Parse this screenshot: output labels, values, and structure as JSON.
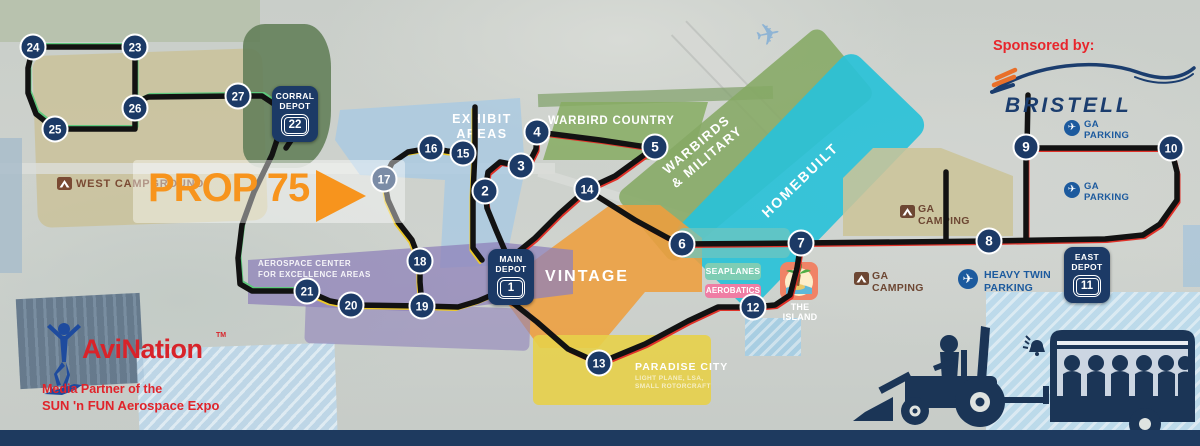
{
  "prop_overlay": {
    "label": "PROP 75"
  },
  "sponsor": {
    "label": "Sponsored by:",
    "brand": "BRISTELL"
  },
  "media_partner": {
    "brand": "AviNation",
    "tm": "TM",
    "line1": "Media Partner of the",
    "line2": "SUN 'n FUN Aerospace Expo"
  },
  "depots": {
    "corral": {
      "line1": "CORRAL",
      "line2": "DEPOT",
      "number": "22"
    },
    "main": {
      "line1": "MAIN",
      "line2": "DEPOT",
      "number": "1"
    },
    "east": {
      "line1": "EAST",
      "line2": "DEPOT",
      "number": "11"
    }
  },
  "areas": {
    "west_campground": {
      "label": "WEST CAMPGROUND"
    },
    "exhibit": {
      "line1": "EXHIBIT",
      "line2": "AREAS"
    },
    "warbird_country": {
      "label": "WARBIRD COUNTRY"
    },
    "warbirds_military": {
      "line1": "WARBIRDS",
      "line2": "& MILITARY"
    },
    "homebuilt": {
      "label": "HOMEBUILT"
    },
    "vintage": {
      "label": "VINTAGE"
    },
    "ga_camping_north": {
      "line1": "GA",
      "line2": "CAMPING"
    },
    "ga_camping_south": {
      "line1": "GA",
      "line2": "CAMPING"
    },
    "ga_parking_north": {
      "line1": "GA",
      "line2": "PARKING"
    },
    "ga_parking_south": {
      "line1": "GA",
      "line2": "PARKING"
    },
    "seaplanes": {
      "label": "SEAPLANES"
    },
    "aerobatics": {
      "label": "AEROBATICS"
    },
    "island": {
      "label": "THE ISLAND"
    },
    "heavy_twin": {
      "line1": "HEAVY TWIN",
      "line2": "PARKING"
    },
    "aerospace": {
      "line1": "AEROSPACE CENTER",
      "line2": "FOR EXCELLENCE AREAS"
    },
    "paradise": {
      "label": "PARADISE CITY",
      "sub1": "LIGHT PLANE, LSA,",
      "sub2": "SMALL ROTORCRAFT"
    }
  },
  "stops": [
    {
      "n": "2",
      "x": 485,
      "y": 191
    },
    {
      "n": "3",
      "x": 521,
      "y": 166
    },
    {
      "n": "4",
      "x": 537,
      "y": 132
    },
    {
      "n": "5",
      "x": 655,
      "y": 147
    },
    {
      "n": "6",
      "x": 682,
      "y": 244
    },
    {
      "n": "7",
      "x": 801,
      "y": 243
    },
    {
      "n": "8",
      "x": 989,
      "y": 241
    },
    {
      "n": "9",
      "x": 1026,
      "y": 147
    },
    {
      "n": "10",
      "x": 1171,
      "y": 148
    },
    {
      "n": "12",
      "x": 753,
      "y": 307
    },
    {
      "n": "13",
      "x": 599,
      "y": 363
    },
    {
      "n": "14",
      "x": 587,
      "y": 189
    },
    {
      "n": "15",
      "x": 463,
      "y": 153
    },
    {
      "n": "16",
      "x": 431,
      "y": 148
    },
    {
      "n": "17",
      "x": 384,
      "y": 179
    },
    {
      "n": "18",
      "x": 420,
      "y": 261
    },
    {
      "n": "19",
      "x": 422,
      "y": 306
    },
    {
      "n": "20",
      "x": 351,
      "y": 305
    },
    {
      "n": "21",
      "x": 307,
      "y": 291
    },
    {
      "n": "23",
      "x": 135,
      "y": 47
    },
    {
      "n": "24",
      "x": 33,
      "y": 47
    },
    {
      "n": "25",
      "x": 55,
      "y": 129
    },
    {
      "n": "26",
      "x": 135,
      "y": 108
    },
    {
      "n": "27",
      "x": 238,
      "y": 96
    }
  ],
  "routes": [
    {
      "accent": "#5fc97d",
      "ax": 2,
      "ay": -2.5,
      "points": [
        [
          33,
          47
        ],
        [
          135,
          47
        ]
      ]
    },
    {
      "accent": "#5fc97d",
      "ax": 2,
      "ay": -2.5,
      "points": [
        [
          135,
          47
        ],
        [
          135,
          108
        ]
      ]
    },
    {
      "accent": "#5fc97d",
      "ax": 2,
      "ay": -2.5,
      "points": [
        [
          33,
          47
        ],
        [
          28,
          68
        ],
        [
          28,
          93
        ],
        [
          36,
          114
        ],
        [
          55,
          129
        ]
      ]
    },
    {
      "accent": "#5fc97d",
      "ax": 2,
      "ay": -2.5,
      "points": [
        [
          55,
          129
        ],
        [
          135,
          129
        ],
        [
          135,
          108
        ]
      ]
    },
    {
      "accent": "#5fc97d",
      "ax": 2,
      "ay": -2.5,
      "points": [
        [
          135,
          103
        ],
        [
          148,
          97
        ],
        [
          238,
          96
        ],
        [
          262,
          96
        ],
        [
          277,
          106
        ],
        [
          283,
          122
        ],
        [
          272,
          155
        ],
        [
          254,
          192
        ],
        [
          242,
          225
        ],
        [
          238,
          258
        ],
        [
          240,
          284
        ],
        [
          252,
          291
        ],
        [
          307,
          291
        ]
      ]
    },
    {
      "accent": "#edc928",
      "ax": -2,
      "ay": 2.5,
      "points": [
        [
          307,
          291
        ],
        [
          330,
          301
        ],
        [
          351,
          305
        ],
        [
          422,
          306
        ]
      ]
    },
    {
      "accent": "#edc928",
      "ax": -2,
      "ay": 2.5,
      "points": [
        [
          422,
          306
        ],
        [
          420,
          282
        ],
        [
          420,
          261
        ]
      ]
    },
    {
      "accent": "#edc928",
      "ax": -2,
      "ay": 2.5,
      "points": [
        [
          420,
          261
        ],
        [
          412,
          240
        ],
        [
          398,
          222
        ],
        [
          388,
          200
        ],
        [
          384,
          179
        ]
      ]
    },
    {
      "accent": "#edc928",
      "ax": -2,
      "ay": 2.5,
      "points": [
        [
          384,
          179
        ],
        [
          392,
          163
        ],
        [
          408,
          152
        ],
        [
          431,
          148
        ]
      ]
    },
    {
      "accent": "#edc928",
      "ax": -2,
      "ay": 2.5,
      "points": [
        [
          431,
          148
        ],
        [
          447,
          151
        ],
        [
          463,
          153
        ]
      ]
    },
    {
      "accent": "#edc928",
      "ax": -2,
      "ay": 2.5,
      "points": [
        [
          475,
          107
        ],
        [
          475,
          150
        ],
        [
          473,
          195
        ],
        [
          473,
          248
        ],
        [
          482,
          260
        ]
      ]
    },
    {
      "accent": "#edc928",
      "ax": -2,
      "ay": 2.5,
      "points": [
        [
          422,
          306
        ],
        [
          458,
          307
        ],
        [
          478,
          301
        ],
        [
          492,
          295
        ]
      ]
    },
    {
      "accent": "#e03229",
      "ax": 2,
      "ay": 2.5,
      "points": [
        [
          505,
          251
        ],
        [
          496,
          230
        ],
        [
          487,
          208
        ],
        [
          485,
          191
        ]
      ]
    },
    {
      "accent": "#e03229",
      "ax": 2,
      "ay": 2.5,
      "points": [
        [
          485,
          191
        ],
        [
          488,
          172
        ],
        [
          500,
          162
        ],
        [
          521,
          166
        ]
      ]
    },
    {
      "accent": "#e03229",
      "ax": 2,
      "ay": 2.5,
      "points": [
        [
          521,
          166
        ],
        [
          531,
          159
        ],
        [
          536,
          149
        ],
        [
          537,
          132
        ]
      ]
    },
    {
      "accent": "#e03229",
      "ax": 2,
      "ay": 2.5,
      "points": [
        [
          537,
          132
        ],
        [
          600,
          140
        ],
        [
          640,
          146
        ],
        [
          655,
          147
        ]
      ]
    },
    {
      "accent": "#e03229",
      "ax": 2,
      "ay": 2.5,
      "points": [
        [
          655,
          147
        ],
        [
          615,
          176
        ],
        [
          587,
          189
        ],
        [
          560,
          213
        ],
        [
          535,
          238
        ],
        [
          519,
          251
        ]
      ]
    },
    {
      "accent": "#e03229",
      "ax": 2,
      "ay": 2.5,
      "points": [
        [
          589,
          191
        ],
        [
          635,
          220
        ],
        [
          668,
          238
        ],
        [
          682,
          244
        ]
      ]
    },
    {
      "accent": "#e03229",
      "ax": 2,
      "ay": 2.5,
      "points": [
        [
          682,
          244
        ],
        [
          801,
          243
        ],
        [
          989,
          241
        ],
        [
          1105,
          239
        ],
        [
          1143,
          235
        ]
      ]
    },
    {
      "accent": "#e03229",
      "ax": 2,
      "ay": 2.5,
      "points": [
        [
          1026,
          240
        ],
        [
          1026,
          148
        ]
      ]
    },
    {
      "accent": "#e03229",
      "ax": 2,
      "ay": 2.5,
      "points": [
        [
          1026,
          148
        ],
        [
          1171,
          148
        ]
      ]
    },
    {
      "accent": "#e03229",
      "ax": 2,
      "ay": 2.5,
      "points": [
        [
          1171,
          148
        ],
        [
          1177,
          172
        ],
        [
          1177,
          200
        ],
        [
          1160,
          224
        ],
        [
          1143,
          235
        ]
      ]
    },
    {
      "accent": "#e03229",
      "ax": 2,
      "ay": 2.5,
      "points": [
        [
          801,
          243
        ],
        [
          797,
          268
        ],
        [
          790,
          295
        ],
        [
          775,
          305
        ],
        [
          753,
          307
        ]
      ]
    },
    {
      "accent": "#e03229",
      "ax": 2,
      "ay": 2.5,
      "points": [
        [
          753,
          307
        ],
        [
          718,
          307
        ],
        [
          688,
          321
        ],
        [
          645,
          344
        ],
        [
          599,
          363
        ]
      ]
    },
    {
      "accent": "#e03229",
      "ax": 2,
      "ay": 2.5,
      "points": [
        [
          599,
          363
        ],
        [
          568,
          349
        ],
        [
          537,
          322
        ],
        [
          513,
          303
        ],
        [
          493,
          295
        ]
      ]
    },
    {
      "accent": null,
      "points": [
        [
          1027,
          148
        ],
        [
          1028,
          95
        ]
      ]
    },
    {
      "accent": null,
      "points": [
        [
          946,
          241
        ],
        [
          946,
          172
        ]
      ]
    },
    {
      "accent": null,
      "points": [
        [
          294,
          136
        ],
        [
          286,
          148
        ]
      ]
    }
  ],
  "colors": {
    "stop_navy": "#1c3a66",
    "route_black": "#121212",
    "accent_red": "#e03229",
    "accent_yellow": "#edc928",
    "accent_green": "#5fc97d",
    "prop_orange": "#f7941d"
  }
}
